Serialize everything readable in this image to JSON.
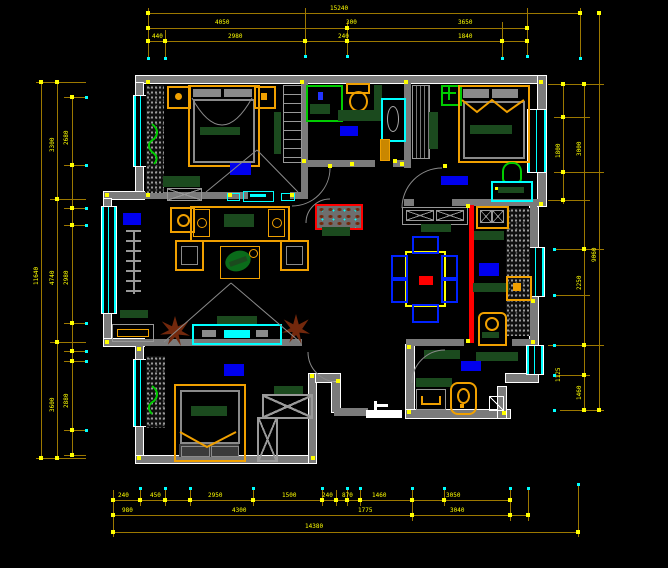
{
  "title": "apartment-floor-plan-cad-drawing",
  "colors": {
    "background": "#000000",
    "wall": "#7b7b7b",
    "outline": "#ffffff",
    "dimension": "#ffff00",
    "dimension_line": "#9c7800",
    "window": "#00ffff",
    "furniture_orange": "#f0a000",
    "counter_green": "#1b4a1e",
    "fixture_green": "#00cc00",
    "rug_blue": "#0000ee",
    "accent_red": "#ff0000",
    "plant_brown": "#73280c"
  },
  "icons": {
    "bed": "orange-frame-rectangle",
    "toilet": "orange-oval-with-tank",
    "shower": "green-square-with-drop",
    "ceiling-fan": "green-cross-in-box",
    "dining-table": "yellow-rect-red-center",
    "chair": "blue-small-box",
    "plant": "brown-starburst",
    "radiator": "gray-ladder",
    "tv": "cyan-bar",
    "door": "gray-quarter-arc",
    "window": "triple-cyan-lines",
    "wardrobe": "crossed-box"
  },
  "dims": {
    "top1": [
      "15240"
    ],
    "top2": [
      "4050",
      "300",
      "3650"
    ],
    "top3": [
      "440",
      "2980",
      "240",
      "1840"
    ],
    "left_outer": [
      "11640"
    ],
    "left_mid": [
      "3300",
      "4740",
      "3600"
    ],
    "left_inner": [
      "2680",
      "2980",
      "2880"
    ],
    "right_inner": [
      "1800",
      "1125"
    ],
    "right_mid": [
      "3000",
      "2250",
      "1460"
    ],
    "right_outer": [
      "9060"
    ],
    "bottom1": [
      "240",
      "450",
      "2950",
      "1500",
      "240",
      "870",
      "1460",
      "3050"
    ],
    "bottom2": [
      "980",
      "4300",
      "1775",
      "3040"
    ],
    "bottom3": [
      "14380"
    ]
  }
}
